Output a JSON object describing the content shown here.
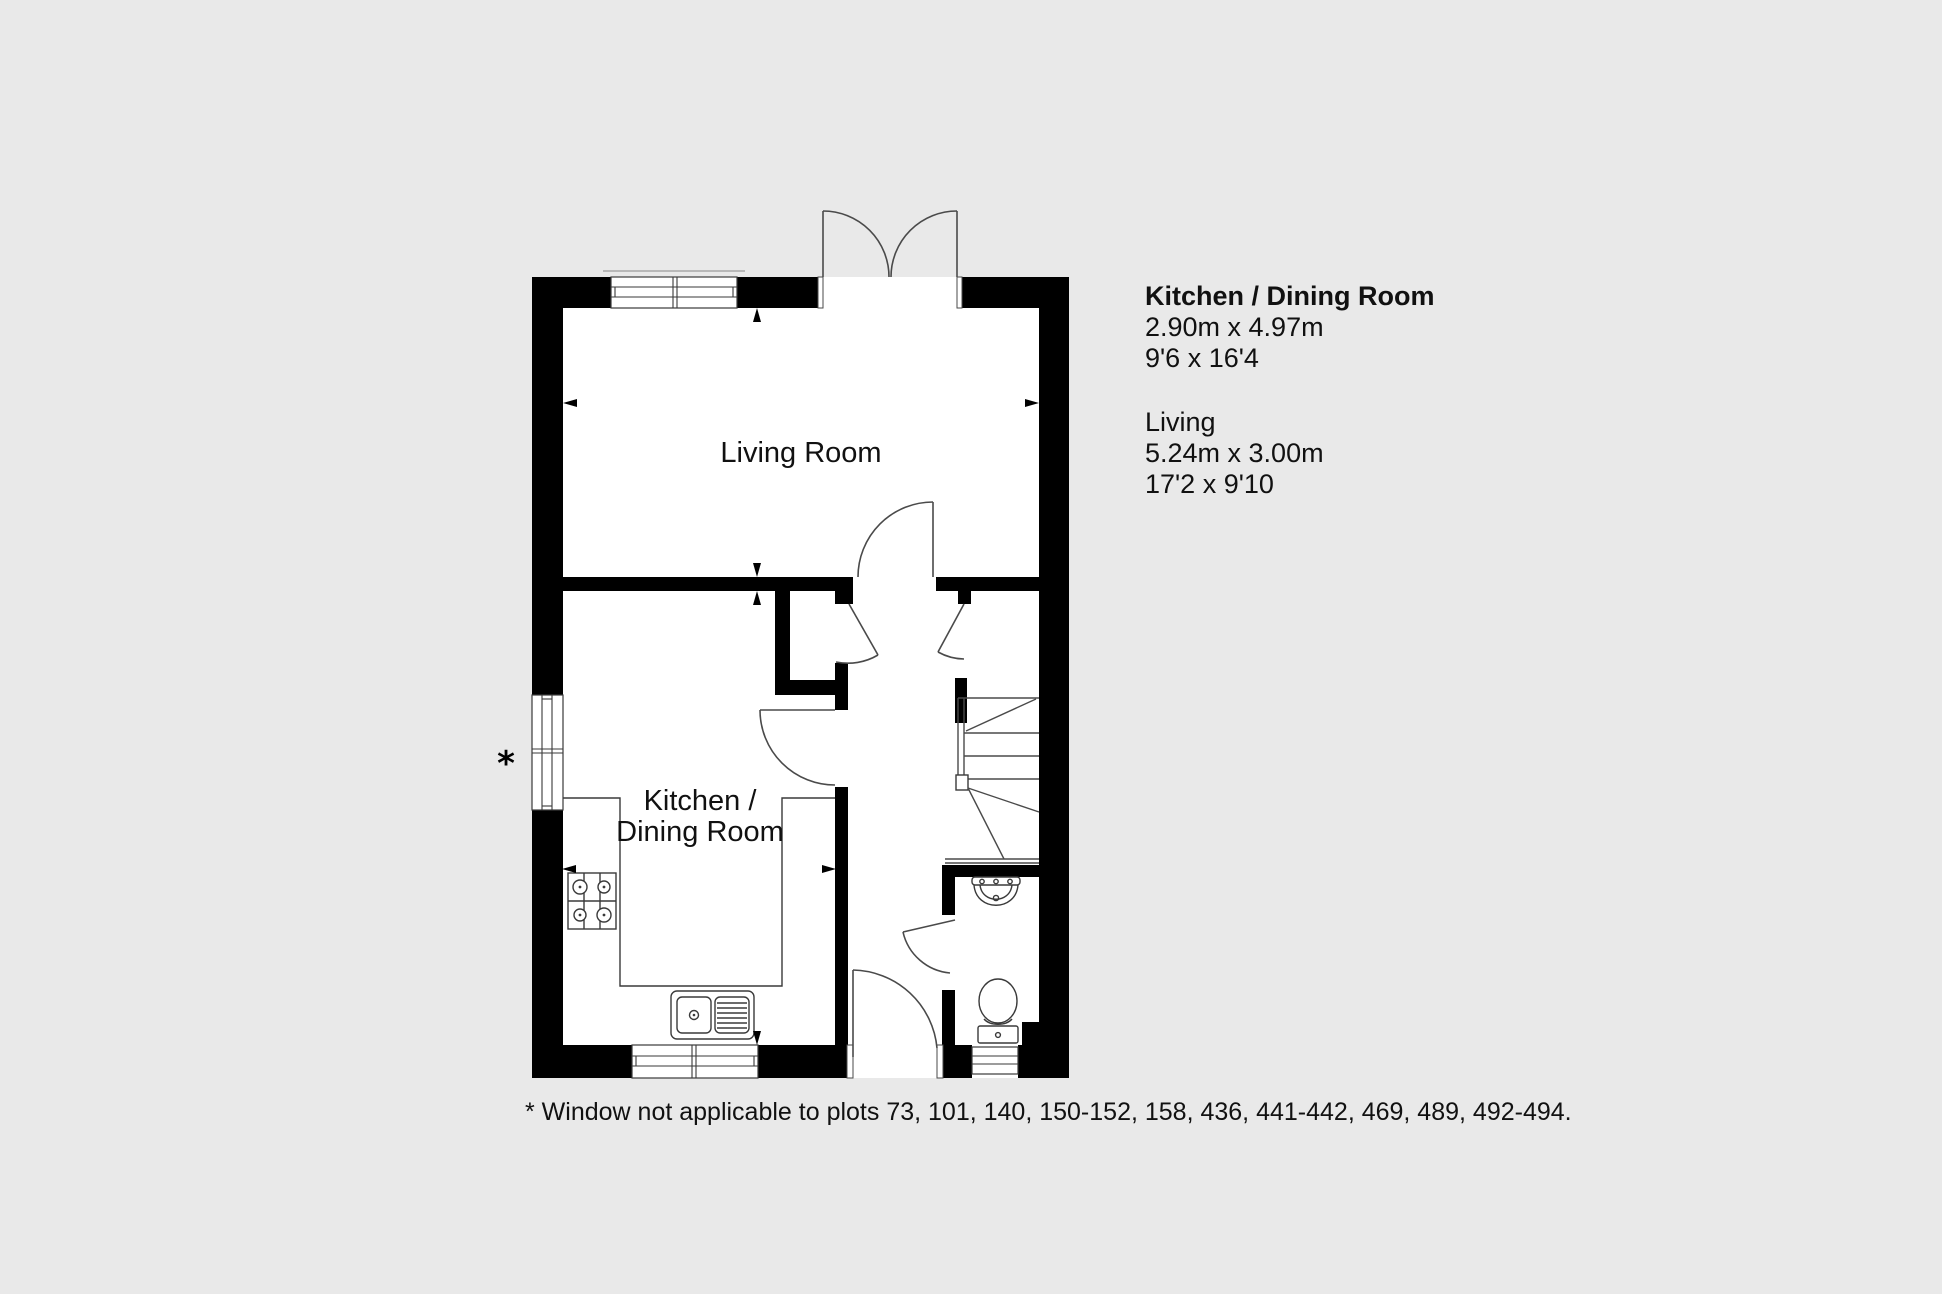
{
  "colors": {
    "background": "#E9E9E9",
    "wall": "#000000",
    "floor": "#FFFFFF",
    "door_line": "#4A4A4A",
    "fixture_line": "#3A3A3A",
    "text": "#111111"
  },
  "floorplan": {
    "rooms": {
      "living_room": {
        "label": "Living Room"
      },
      "kitchen_dining": {
        "label_line1": "Kitchen /",
        "label_line2": "Dining Room"
      }
    },
    "window_note_marker": "*"
  },
  "dimensions_panel": {
    "kitchen": {
      "title": "Kitchen / Dining Room",
      "metric": "2.90m x 4.97m",
      "imperial": "9'6 x 16'4"
    },
    "living": {
      "title": "Living",
      "metric": "5.24m x 3.00m",
      "imperial": "17'2 x 9'10"
    }
  },
  "footnote": "* Window not applicable to plots 73, 101, 140, 150-152, 158, 436, 441-442, 469, 489, 492-494."
}
